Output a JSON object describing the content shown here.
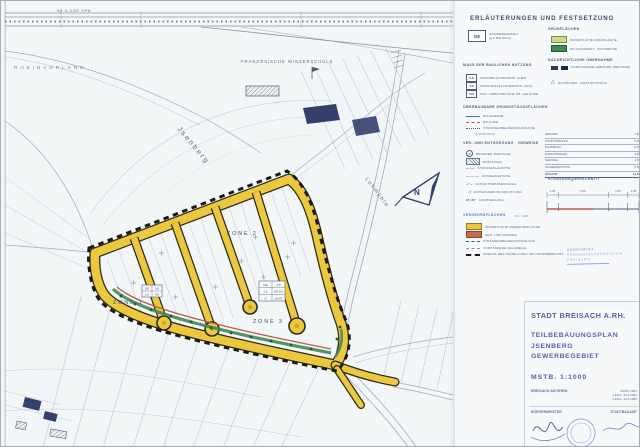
{
  "palette": {
    "road_yellow": "#ecc83f",
    "footpath_red": "#bf5a4b",
    "planting_green": "#3f8a55",
    "boundary_black": "#1a1a1a",
    "title_violet": "#5a5ea9",
    "legend_ink": "#4e5f7b",
    "parcel_blue": "#aab8d0"
  },
  "map": {
    "rail_note": "98  0-03E  0P8",
    "rheinvorland": "RHEINVORLAND",
    "school": "FRANZÖSISCHE  WINZERSCHULE",
    "jsenberg": "Jsenberg",
    "lohmuehle": "Lohmühle",
    "north_letter": "N",
    "zone1": "ZONE 1",
    "zone2": "ZONE 2",
    "zone3": "ZONE 3",
    "schablone_small": [
      "GE",
      "0,8",
      "1,6",
      "GH"
    ],
    "schablone_large": [
      "GE",
      "0,8",
      "1,6",
      "GH 9,0",
      "O",
      "15-25°"
    ]
  },
  "legend": {
    "title": "ERLÄUTERUNGEN UND FESTSETZUNG",
    "ge": {
      "symbol": "GE",
      "line1": "GEWERBEGEBIET",
      "line2": "(§ 8 BAUNVO)"
    },
    "nutzung": {
      "header": "MASS DER BAULICHEN NUTZUNG",
      "rows": [
        {
          "sym": "0,8",
          "label": "GRUNDFLÄCHENZAHL (GRZ)"
        },
        {
          "sym": "1,6",
          "label": "GESCHOSSFLÄCHENZAHL (GFZ)"
        },
        {
          "sym": "GH",
          "label": "MAX. GEBÄUDEHÖHE ÜB. GELÄNDE"
        }
      ]
    },
    "bauweise": {
      "header": "ÜBERBAUBARE GRUNDSTÜCKSFLÄCHEN",
      "note": "(§ 23 BAUNVO)",
      "rows": [
        {
          "label": "BAUGRENZE"
        },
        {
          "label": "BAULINIE"
        },
        {
          "label": "STRASSENBEGRENZUNGSLINIE"
        }
      ]
    },
    "versorgung": {
      "header": "VER- UND ENTSORGUNG · HINWEISE",
      "rows": [
        {
          "sym": "B",
          "label": "BRUNNEN (BESTAND)"
        },
        {
          "label": "BÖSCHUNG"
        },
        {
          "sym": "—·—",
          "label": "STRASSENLEUCHTE"
        },
        {
          "sym": "— — —",
          "label": "WASSERLEITUNG"
        },
        {
          "sym": "–··–",
          "label": "SCHMUTZWASSERKANAL"
        },
        {
          "sym": "→|",
          "label": "ENTWÄSSERUNGSRICHTUNG"
        },
        {
          "sym": "15°-25°",
          "label": "DACHNEIGUNG"
        }
      ]
    },
    "verkehr": {
      "header": "VERKEHRSFLÄCHEN",
      "note": "M 1 : 1000",
      "rows": [
        {
          "label": "ÖFFENTLICHE VERKEHRSFLÄCHE"
        },
        {
          "label": "GEH- UND RADWEG"
        },
        {
          "label": "STRASSENBEGRENZUNGSLINIE"
        },
        {
          "label": "VORHANDENE FELDWEGE"
        },
        {
          "label": "GRENZE DES RÄUMLICHEN GELTUNGSBEREICHS"
        }
      ]
    },
    "gruen": {
      "header": "GRÜNFLÄCHEN",
      "rows": [
        {
          "label": "ÖFFENTLICHE GRÜNFLÄCHE"
        },
        {
          "label": "PFLANZGEBOT · BAUMREIHE"
        }
      ]
    },
    "nachrichtlich": {
      "header": "NACHRICHTLICHE ÜBERNAHME",
      "rows": [
        {
          "label": "VORHANDENE GEBÄUDE (BESTAND)"
        },
        {
          "label": "DACHFORM · FIRSTRICHTUNG"
        }
      ]
    },
    "tabelle": {
      "rows": [
        [
          "GEHWEG",
          "1,50"
        ],
        [
          "GRÜNSTREIFEN",
          "2,00"
        ],
        [
          "FAHRBAHN",
          "6,50"
        ],
        [
          "PARKSTREIFEN",
          "2,50"
        ],
        [
          "GEHWEG",
          "1,50"
        ],
        [
          "SICHERHEITSSTR.",
          "0,50"
        ],
        [
          "GESAMT",
          "14,50"
        ]
      ]
    },
    "querschnitt": {
      "header": "STRASSENQUERSCHNITT",
      "dims": [
        "1,50",
        "6,50",
        "2,50",
        "1,50"
      ]
    },
    "stamp": {
      "line1": "GENEHMIGT",
      "line2": "REGIERUNGSPRÄSIDIUM",
      "line3": "FREIBURG"
    }
  },
  "titleblock": {
    "city": "STADT BREISACH A.RH.",
    "plan1": "TEILBEBAUUNGSPLAN",
    "plan2": "JSENBERG",
    "plan3": "GEWERBEGEBIET",
    "scale": "MSTB.  1:1000",
    "place": "BREISACH AM RHEIN",
    "date": "MÄRZ 1981",
    "rev1": "1.ERG. 30.4.1984",
    "rev2": "2.ERG. 10.8.1985",
    "sig_left": "BÜRGERMEISTER",
    "sig_right": "STADTBAUAMT"
  }
}
